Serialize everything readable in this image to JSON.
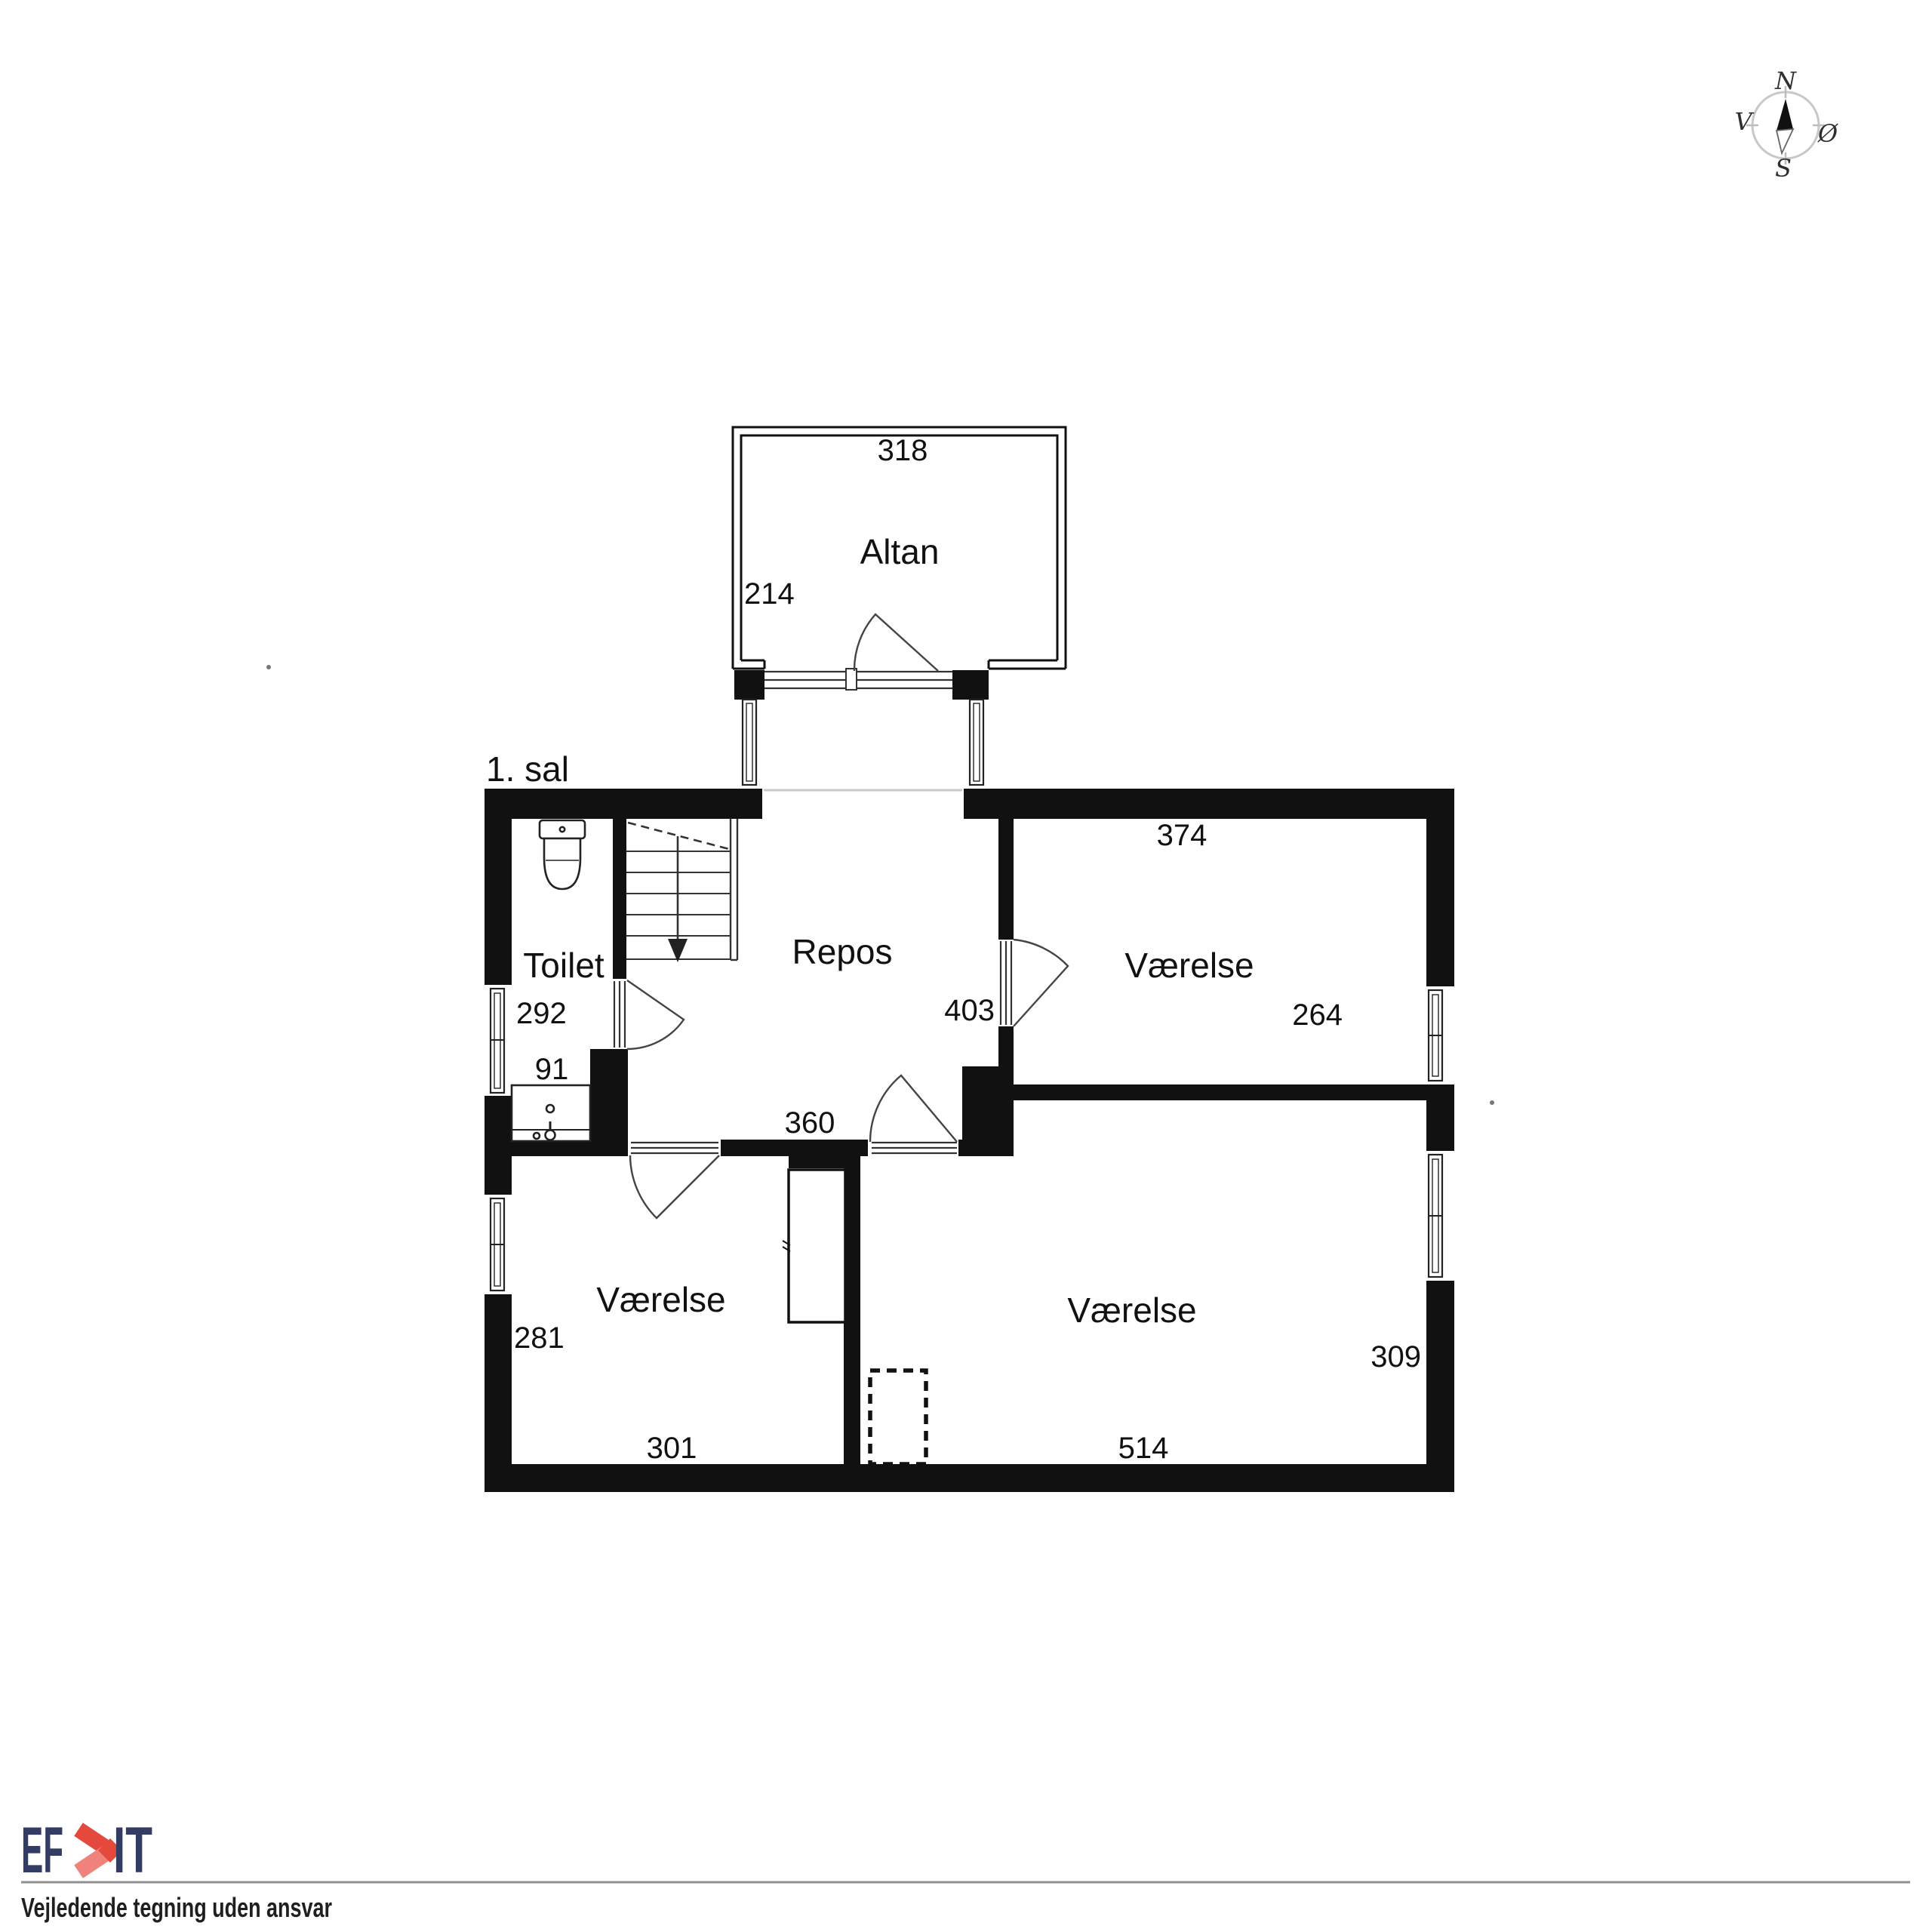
{
  "floor_label": "1. sal",
  "compass": {
    "n": "N",
    "e": "Ø",
    "s": "S",
    "w": "V"
  },
  "rooms": {
    "altan": {
      "name": "Altan",
      "dim_width": "318",
      "dim_depth": "214"
    },
    "toilet": {
      "name": "Toilet",
      "dim_depth": "292",
      "dim_sink": "91"
    },
    "repos": {
      "name": "Repos",
      "dim_door": "403",
      "dim_width": "360"
    },
    "room_ne": {
      "name": "Værelse",
      "dim_width": "374",
      "dim_depth": "264"
    },
    "room_sw": {
      "name": "Værelse",
      "dim_depth": "281",
      "dim_width": "301"
    },
    "room_se": {
      "name": "Værelse",
      "dim_width": "514",
      "dim_depth": "309"
    }
  },
  "footer": {
    "logo_left": "EF",
    "logo_right": "IT",
    "tagline": "Vejledende tegning uden ansvar"
  },
  "colors": {
    "wall": "#111111",
    "logo_navy": "#333c63",
    "logo_red": "#e5493e",
    "logo_red_light": "#ef837b",
    "compass_ring": "#c8c8c8"
  }
}
